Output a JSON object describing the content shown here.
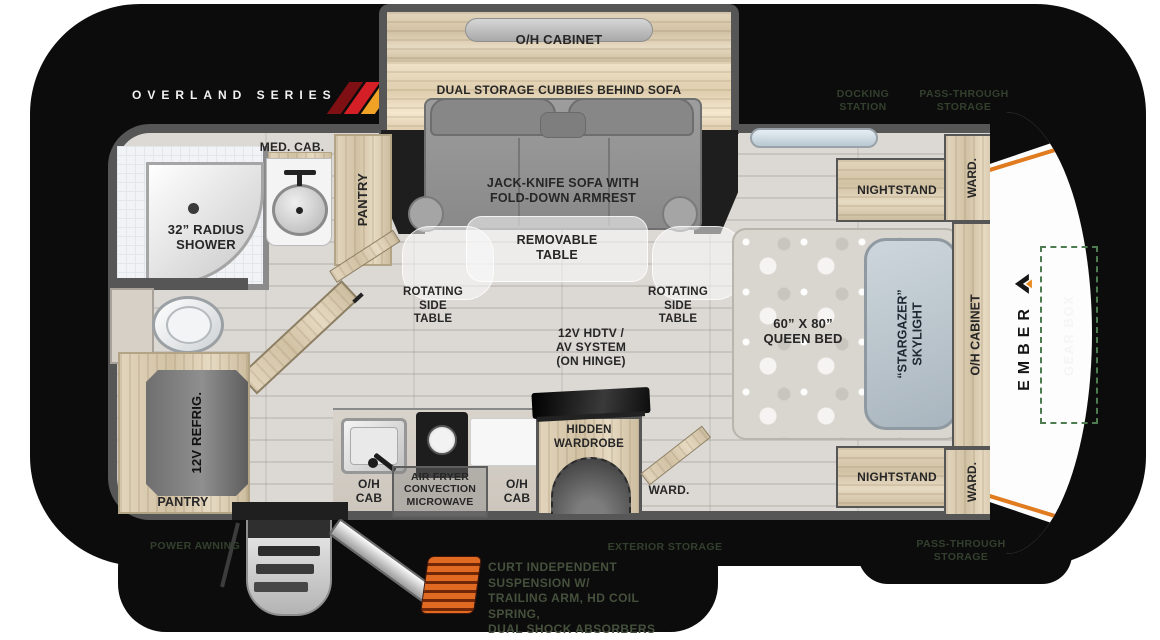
{
  "brand": {
    "series": "OVERLAND SERIES",
    "wordmark": "EMBER"
  },
  "exterior": {
    "docking_line1": "DOCKING",
    "docking_line2": "STATION",
    "pass_line1": "PASS-THROUGH",
    "pass_line2": "STORAGE",
    "power_awning": "POWER AWNING",
    "exterior_storage": "EXTERIOR STORAGE",
    "gear_box": "GEAR BOX",
    "suspension_line1": "CURT INDEPENDENT SUSPENSION W/",
    "suspension_line2": "TRAILING ARM, HD COIL SPRING,",
    "suspension_line3": "DUAL SHOCK ABSORBERS"
  },
  "living": {
    "oh_cabinet": "O/H CABINET",
    "dual_storage": "DUAL STORAGE CUBBIES BEHIND SOFA",
    "sofa_line1": "JACK-KNIFE SOFA WITH",
    "sofa_line2": "FOLD-DOWN ARMREST",
    "table_line1": "REMOVABLE",
    "table_line2": "TABLE",
    "rotating_line1": "ROTATING",
    "rotating_line2": "SIDE",
    "rotating_line3": "TABLE",
    "hdtv_line1": "12V HDTV /",
    "hdtv_line2": "AV SYSTEM",
    "hdtv_line3": "(ON HINGE)"
  },
  "bath": {
    "shower_line1": "32” RADIUS",
    "shower_line2": "SHOWER",
    "med_cab": "MED. CAB.",
    "pantry": "PANTRY"
  },
  "kitchen": {
    "refrig": "12V REFRIG.",
    "pantry": "PANTRY",
    "oh_cab_line1": "O/H",
    "oh_cab_line2": "CAB",
    "micro_line1": "AIR FRYER",
    "micro_line2": "CONVECTION",
    "micro_line3": "MICROWAVE"
  },
  "bedroom": {
    "hidden_line1": "HIDDEN",
    "hidden_line2": "WARDROBE",
    "ward": "WARD.",
    "nightstand": "NIGHTSTAND",
    "bed_line1": "60” X 80”",
    "bed_line2": "QUEEN BED",
    "sky_line1": "“STARGAZER”",
    "sky_line2": "SKYLIGHT",
    "oh_cabinet": "O/H CABINET"
  },
  "colors": {
    "accent_orange": "#e8891f",
    "accent_red": "#d51f26",
    "accent_dark_red": "#7e0f13",
    "dim_label_green": "#33402e"
  }
}
